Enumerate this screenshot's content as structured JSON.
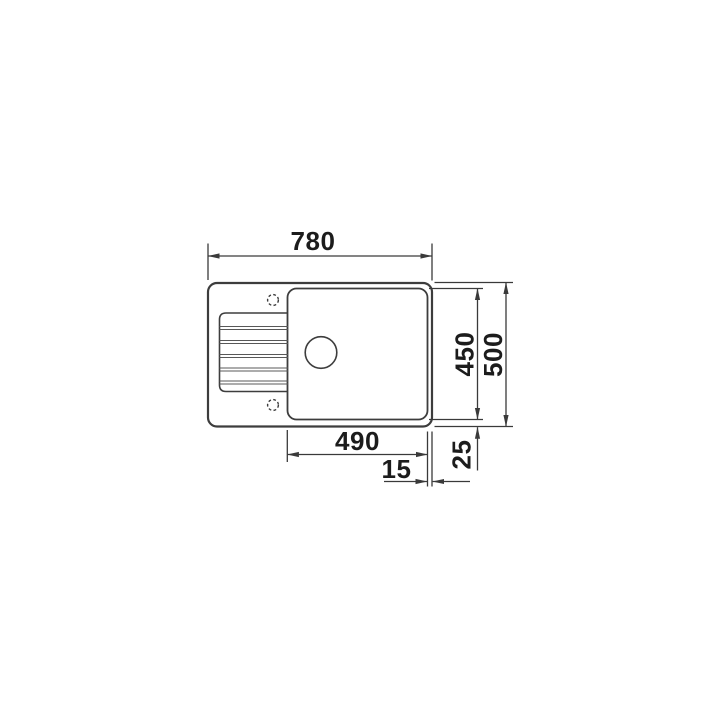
{
  "drawing": {
    "dimensions": {
      "overall_width_mm": "780",
      "overall_depth_mm": "500",
      "bowl_area_depth_mm": "450",
      "bowl_area_width_mm": "490",
      "right_rim_mm": "15",
      "bottom_rim_mm": "25"
    },
    "colors": {
      "background": "#ffffff",
      "outline": "#3d3d3d",
      "dimension_line": "#3a3a3a",
      "label_text": "#1c1c1c"
    }
  }
}
